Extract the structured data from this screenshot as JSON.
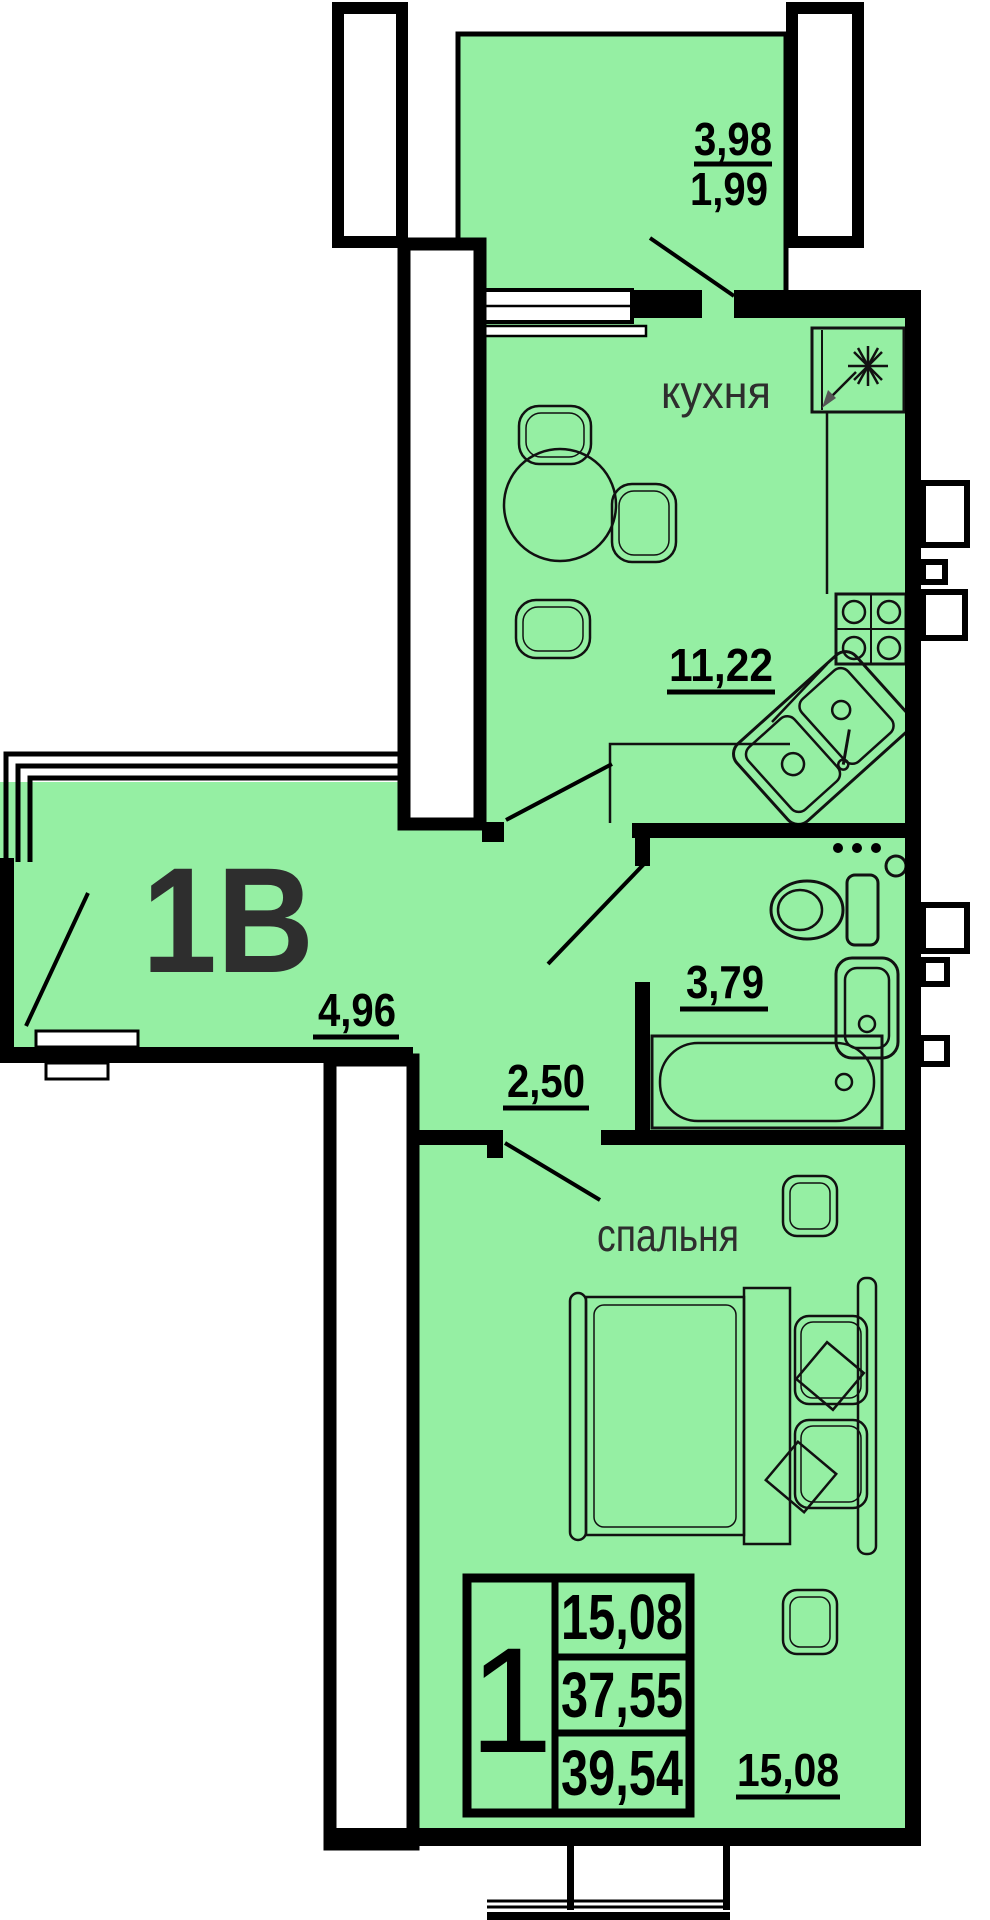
{
  "apartment": {
    "type_label": "1В"
  },
  "rooms": {
    "balcony": {
      "width": "3,98",
      "area": "1,99"
    },
    "kitchen": {
      "name": "кухня",
      "area": "11,22"
    },
    "hallway": {
      "area": "4,96"
    },
    "corridor": {
      "area": "2,50"
    },
    "bathroom": {
      "area": "3,79"
    },
    "bedroom": {
      "name": "спальня",
      "area": "15,08"
    }
  },
  "summary_table": {
    "rooms_count": "1",
    "living_area": "15,08",
    "apartment_area": "37,55",
    "total_area": "39,54"
  },
  "colors": {
    "floor_fill": "#95efa3",
    "wall": "#000000",
    "label_text": "#2e2e2e"
  }
}
